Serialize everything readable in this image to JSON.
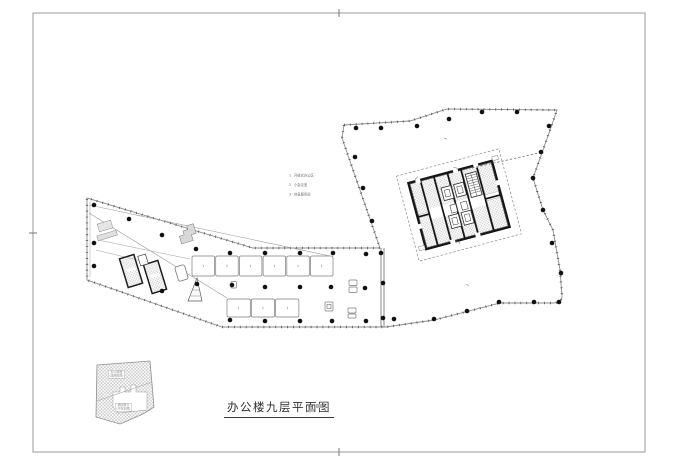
{
  "sheet": {
    "title": "办公楼九层平面图",
    "bg": "#ffffff",
    "border_color": "#9a9a9a"
  },
  "legend": {
    "items": [
      {
        "no": "1",
        "label": "开放式办公区"
      },
      {
        "no": "2",
        "label": "小会议室"
      },
      {
        "no": "3",
        "label": "休息服务间"
      }
    ]
  },
  "key_plan": {
    "label_top": {
      "line1": "办公塔楼",
      "line2": "(本图范围)"
    },
    "label_bottom": {
      "line1": "裙房部分",
      "line2": "(不在本图)"
    }
  },
  "drawing": {
    "colors": {
      "wall": "#151515",
      "line": "#606060",
      "tick": "#3f3f3f",
      "column": "#111111",
      "dashed": "#8a8a8a",
      "hatch": "#a8a8a8",
      "furniture": "#7d7d7d"
    },
    "columns": [
      [
        356,
        128
      ],
      [
        381,
        128
      ],
      [
        417,
        126
      ],
      [
        449,
        119
      ],
      [
        482,
        112
      ],
      [
        517,
        112
      ],
      [
        549,
        126
      ],
      [
        355,
        157
      ],
      [
        363,
        188
      ],
      [
        372,
        221
      ],
      [
        541,
        152
      ],
      [
        533,
        178
      ],
      [
        543,
        210
      ],
      [
        552,
        243
      ],
      [
        561,
        273
      ],
      [
        559,
        302
      ],
      [
        534,
        302
      ],
      [
        499,
        302
      ],
      [
        467,
        311
      ],
      [
        434,
        319
      ],
      [
        394,
        319
      ],
      [
        381,
        253
      ],
      [
        383,
        283
      ],
      [
        383,
        318
      ],
      [
        230,
        253
      ],
      [
        265,
        253
      ],
      [
        300,
        253
      ],
      [
        333,
        253
      ],
      [
        366,
        254
      ],
      [
        232,
        285
      ],
      [
        265,
        287
      ],
      [
        300,
        287
      ],
      [
        331,
        287
      ],
      [
        365,
        288
      ],
      [
        230,
        320
      ],
      [
        265,
        321
      ],
      [
        300,
        321
      ],
      [
        332,
        321
      ],
      [
        366,
        321
      ],
      [
        94,
        205
      ],
      [
        129,
        219
      ],
      [
        162,
        235
      ],
      [
        196,
        249
      ],
      [
        94,
        243
      ],
      [
        94,
        266
      ],
      [
        162,
        291
      ],
      [
        197,
        284
      ]
    ],
    "furniture_top_row": {
      "count": 6,
      "x": 192,
      "y": 256,
      "w": 22.5,
      "gap": 1.2,
      "h": 20
    },
    "furniture_bottom_row": {
      "count": 3,
      "x": 227,
      "y": 299,
      "w": 23.3,
      "gap": 1.0,
      "h": 18
    }
  }
}
